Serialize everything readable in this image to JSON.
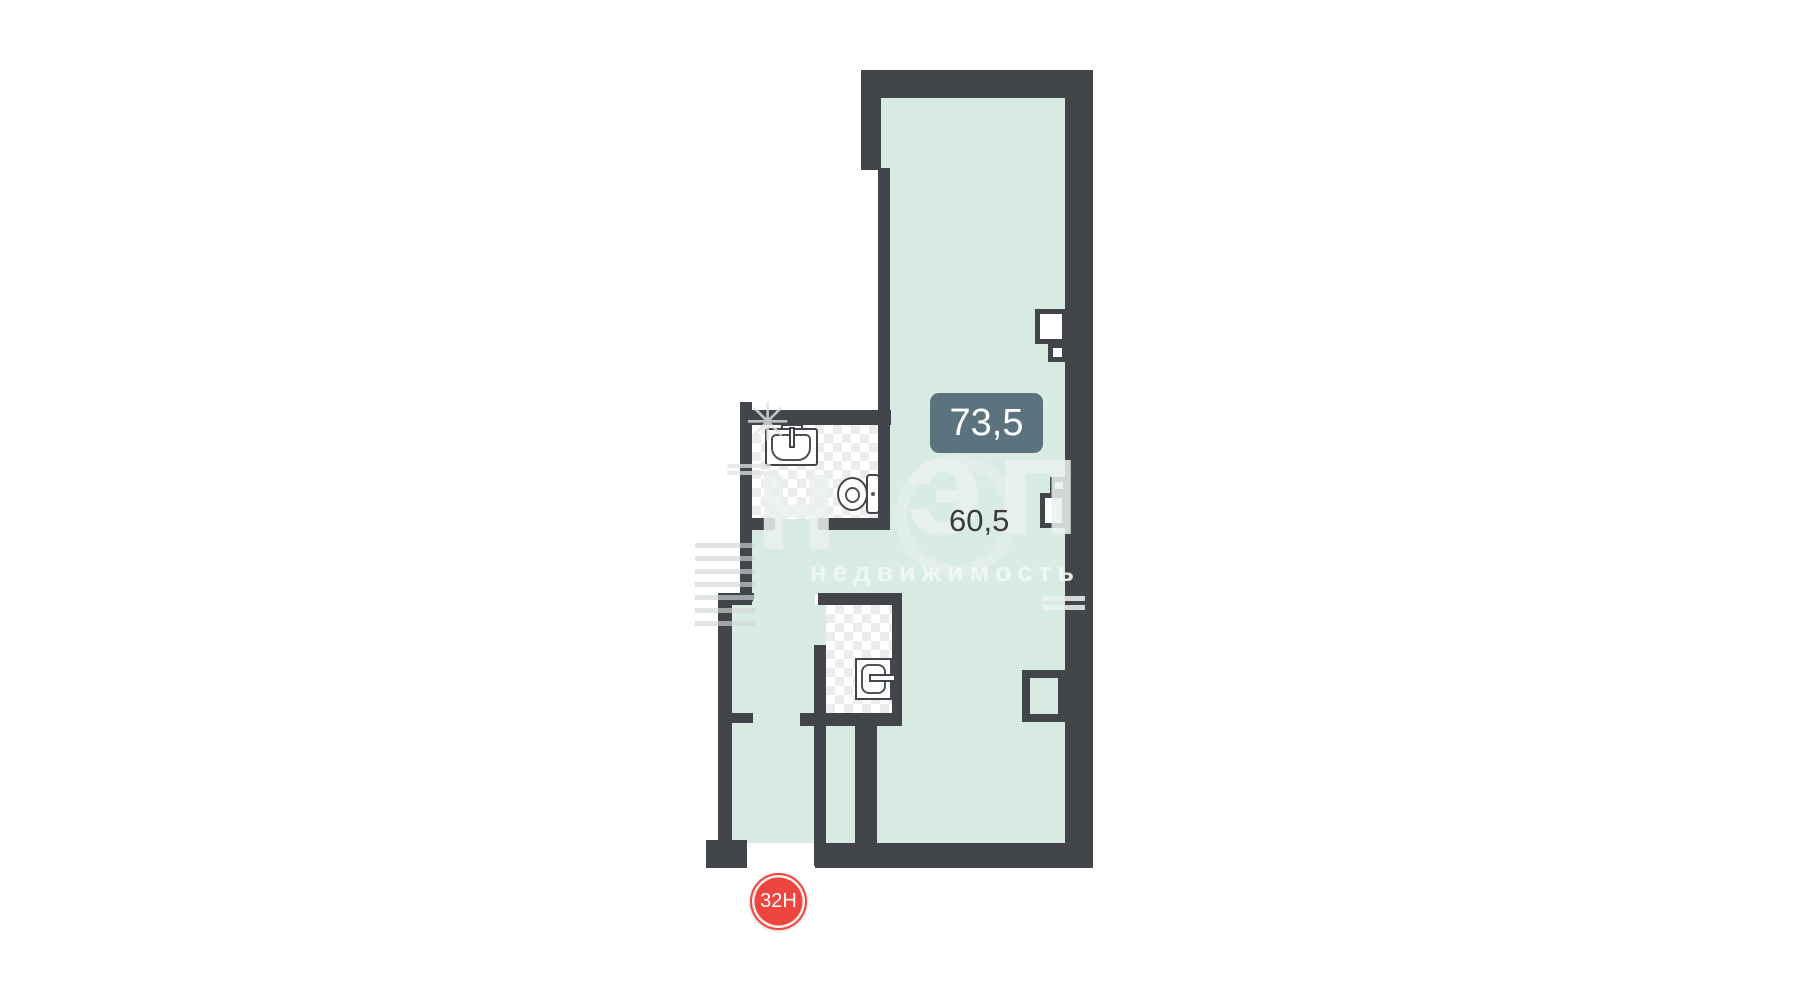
{
  "floor_plan": {
    "unit_number": "32Н",
    "total_area": "73,5",
    "room_area": "60,5",
    "colors": {
      "wall": "#42464a",
      "floor": "#d8ece3",
      "tile_checker": "#ececec",
      "area_badge_bg": "#5b737f",
      "area_badge_text": "#ffffff",
      "room_area_text": "#3b3b3b",
      "unit_badge_bg": "#ee453e",
      "unit_badge_text": "#ffffff"
    },
    "fixtures": [
      "sink-icon",
      "toilet-icon",
      "water-heater-icon"
    ],
    "watermark": {
      "letters": [
        "н",
        "э",
        "п"
      ],
      "subtitle": "недвижимость",
      "star_glyph": "✳"
    }
  }
}
